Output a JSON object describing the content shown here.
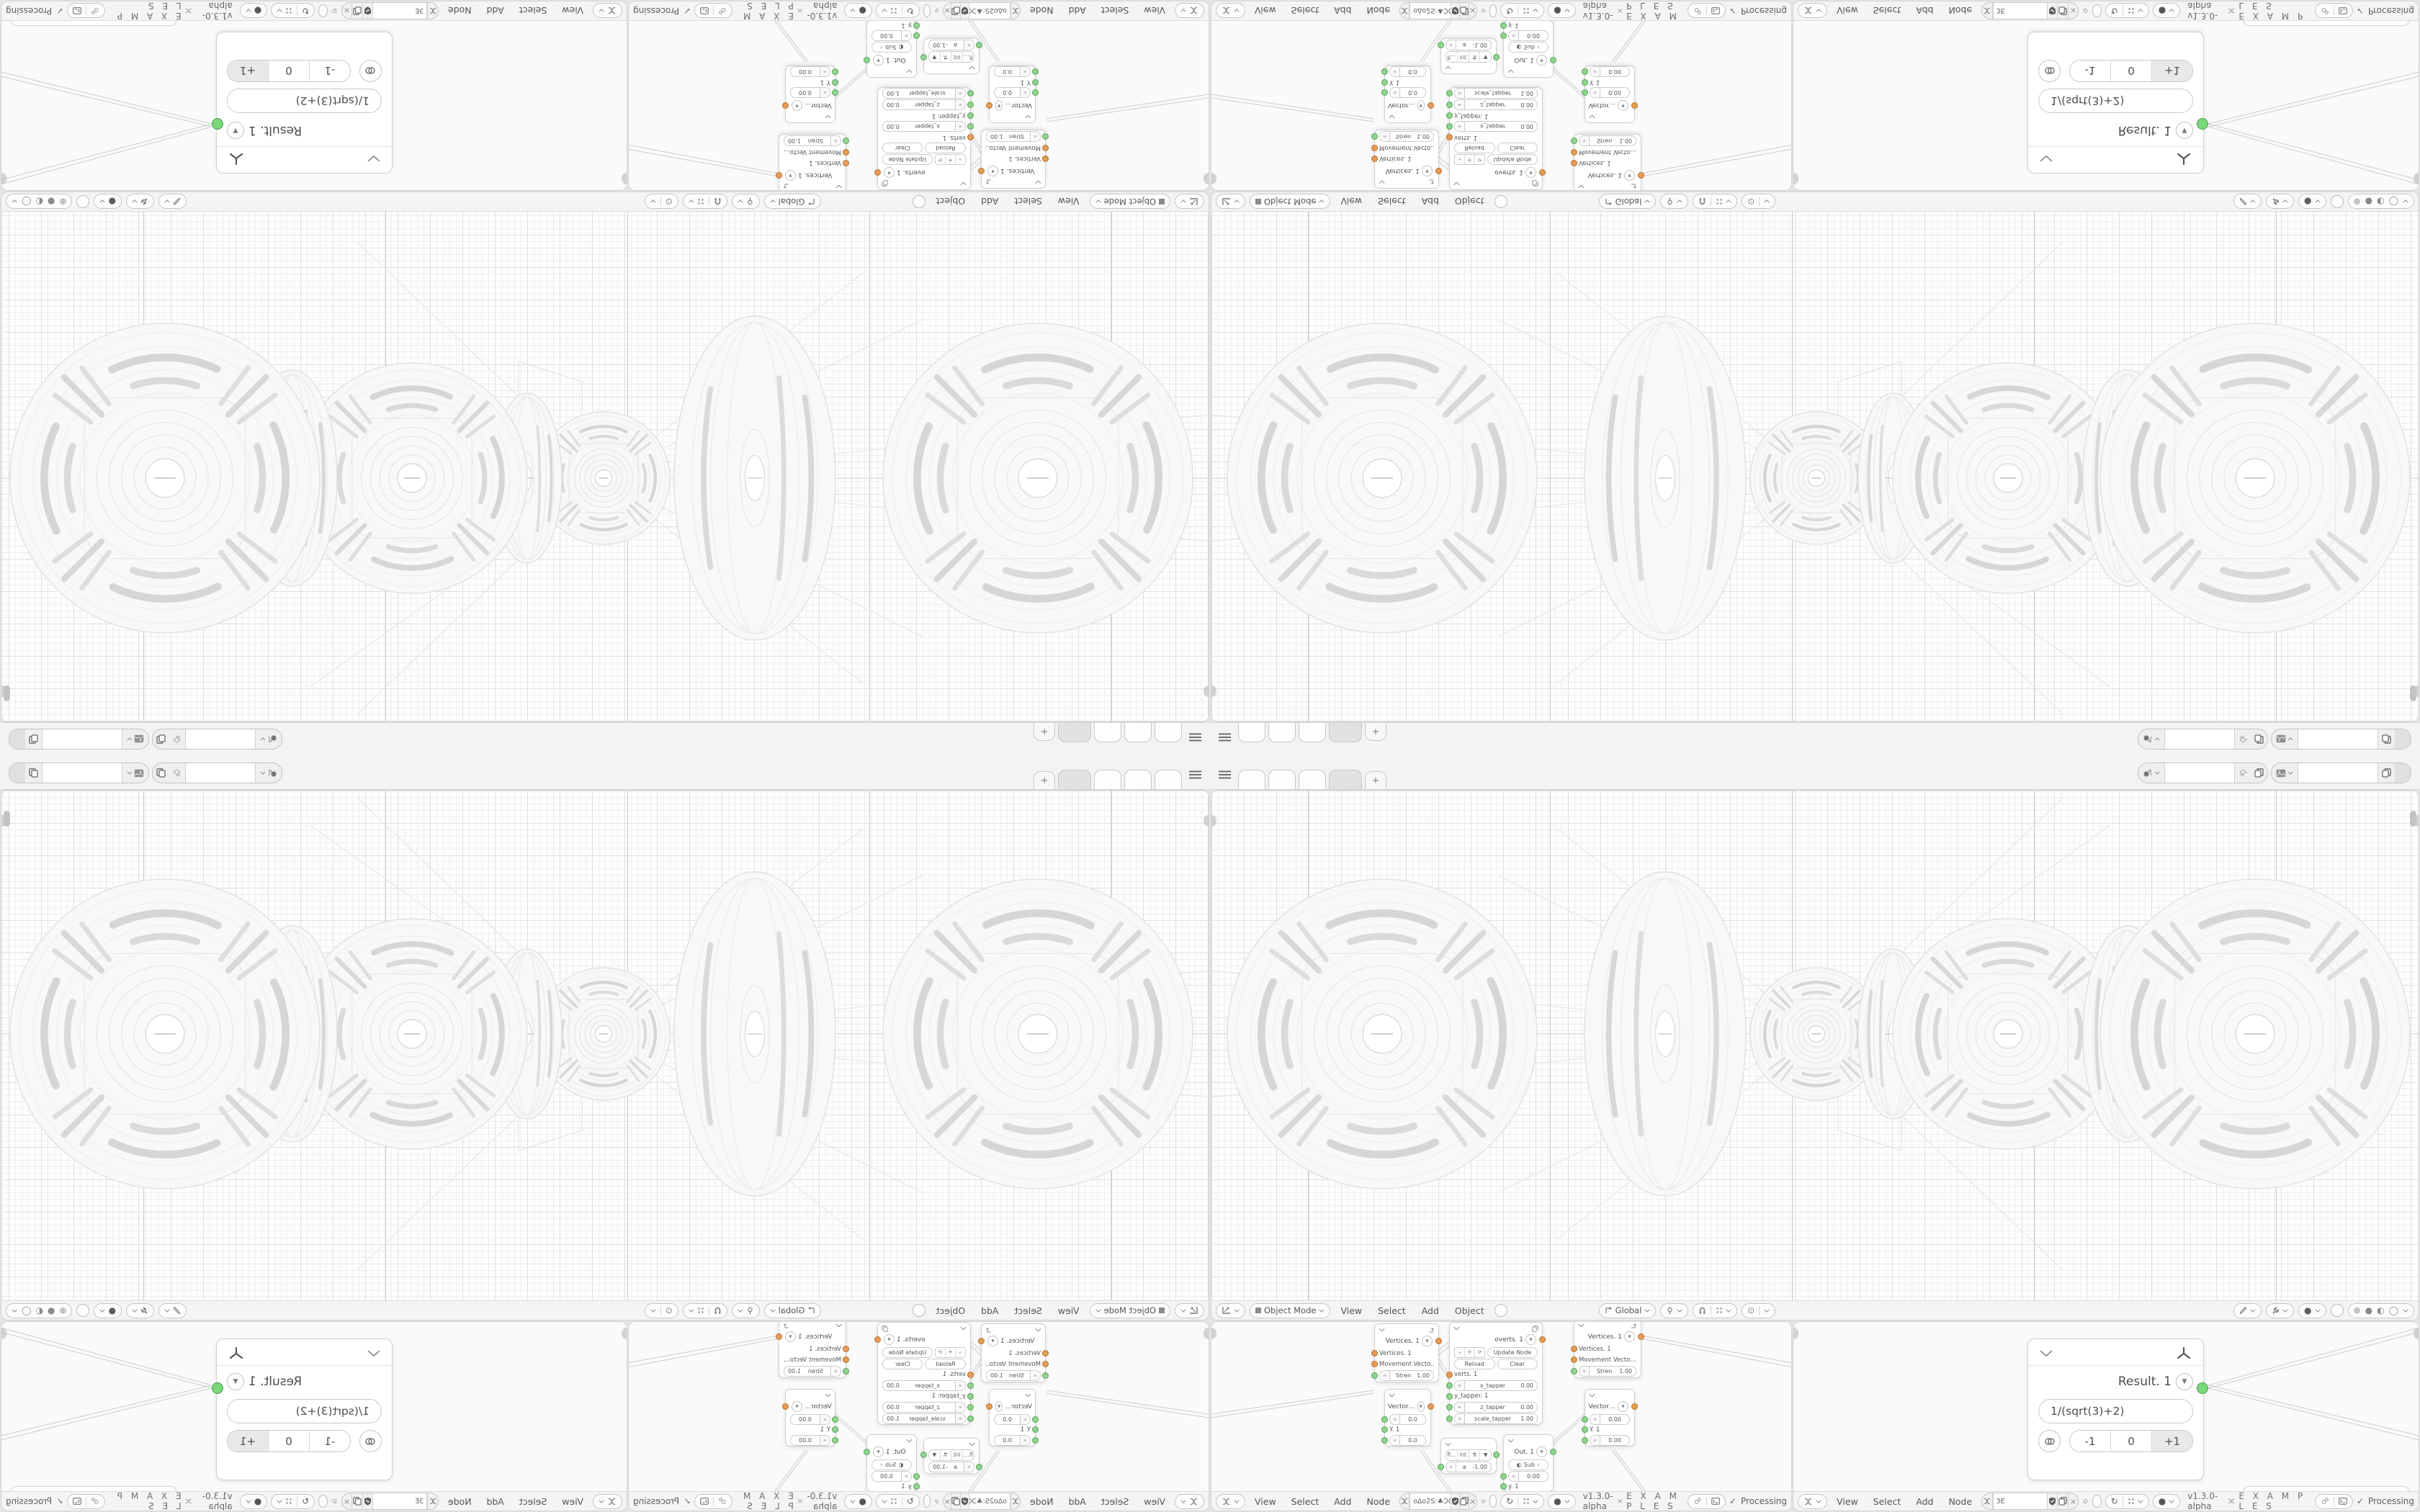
{
  "topbar": {
    "add_tab_label": "+"
  },
  "viewport_header": {
    "mode": "Object Mode",
    "menu_view": "View",
    "menu_select": "Select",
    "menu_add": "Add",
    "menu_object": "Object",
    "orientation": "Global"
  },
  "node_header": {
    "menu_view": "View",
    "menu_select": "Select",
    "menu_add": "Add",
    "menu_node": "Node",
    "version": "v1.3.0-alpha",
    "examples_label": "E X A M P L E S",
    "processing_check": "✓",
    "processing_label": "Processing"
  },
  "editors": {
    "left_tree_name": "oΔo2S:♣ƆC♣ЯRoЯR♣ƆC♣:S2oΔo",
    "right_tree_name": "3E"
  },
  "nodes": {
    "vertices1": {
      "title": "Vertices. 1",
      "in1": "Vertices. 1",
      "in2": "Movement Vecto…",
      "field_label": "Stren",
      "field_value": "1.00"
    },
    "overts": {
      "title": "overts. 1",
      "btn_update": "Update Node",
      "btn_reload": "Reload",
      "btn_clear": "Clear",
      "in1": "verts. 1",
      "f1_label": "x_tapper",
      "f1_value": "0.00",
      "in2": "y_tapper. 1",
      "f2_label": "z_tapper",
      "f2_value": "0.00",
      "f3_label": "scale_tapper",
      "f3_value": "1.00"
    },
    "vector1": {
      "title": "Vector…",
      "v1": "0.0",
      "mid": "Y. 1",
      "v2": "0.0"
    },
    "vector2": {
      "title": "Vector…",
      "v1": "0.00",
      "mid": "Y. 1",
      "v2": "0.00"
    },
    "switch": {
      "opt1": "fl…",
      "opt2": "int",
      "arrow": "▼",
      "field_label": "a",
      "field_value": "-1.00"
    },
    "out": {
      "title": "Out. 1",
      "op": "Sub",
      "value": "0.00",
      "in_bottom": "y. 1"
    },
    "result": {
      "title": "Result. 1",
      "formula": "1/(sqrt(3)+2)",
      "dec": "-1",
      "zero": "0",
      "inc": "+1"
    }
  }
}
